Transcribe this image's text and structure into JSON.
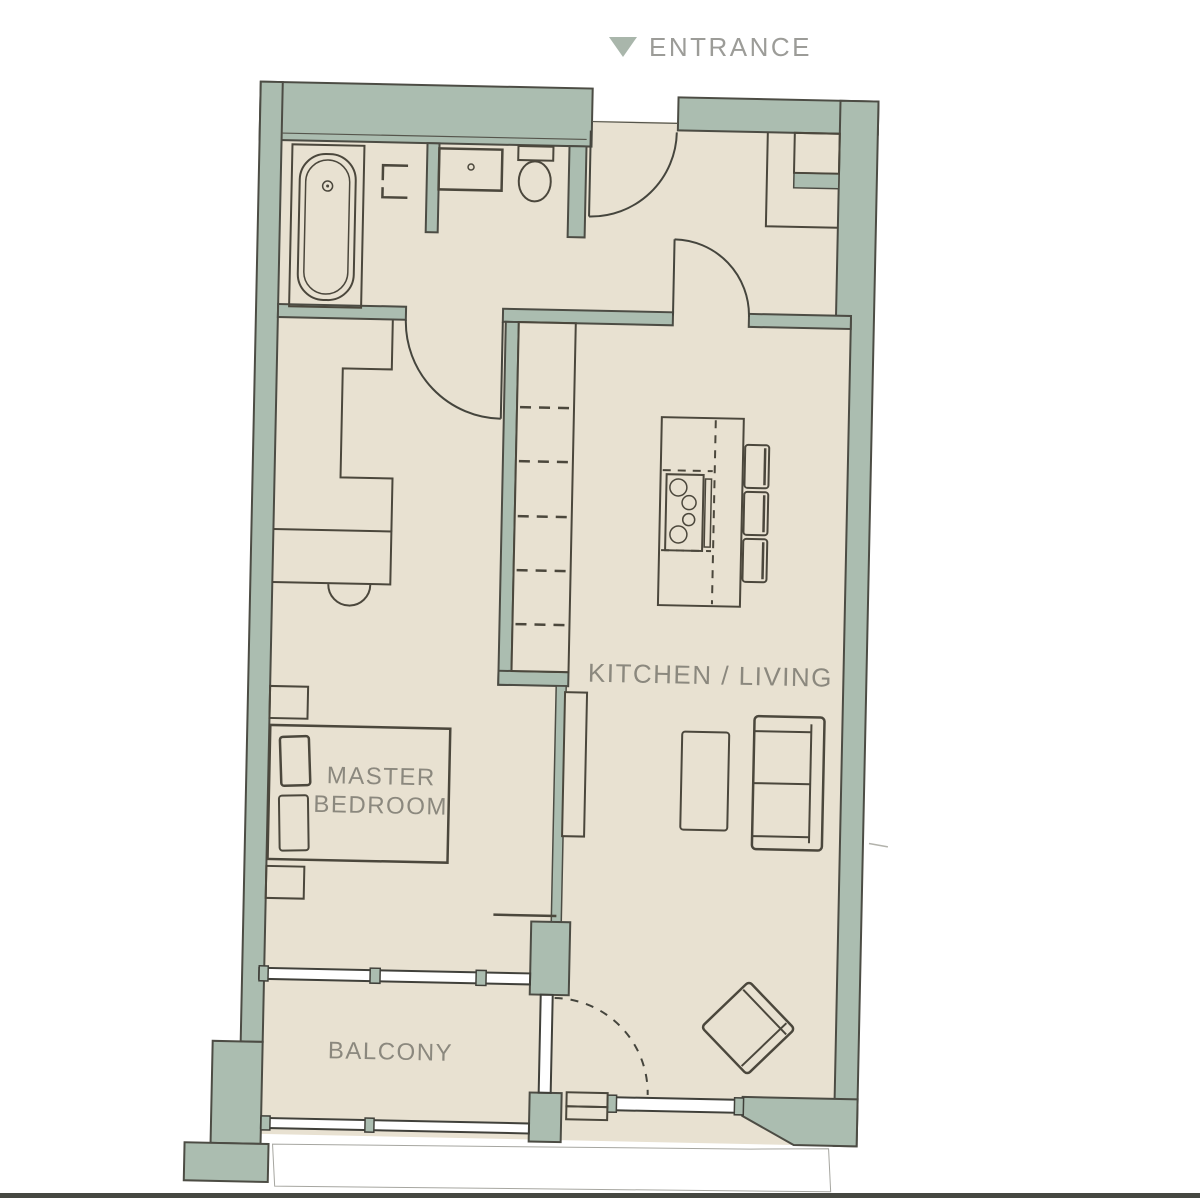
{
  "title": "apartment-floor-plan",
  "labels": {
    "entrance": "ENTRANCE",
    "kitchen_living": "KITCHEN / LIVING",
    "master_bedroom_line1": "MASTER",
    "master_bedroom_line2": "BEDROOM",
    "balcony": "BALCONY"
  },
  "rooms": [
    "entrance-hall",
    "bathroom",
    "master-bedroom",
    "kitchen-living",
    "balcony"
  ],
  "fixtures": [
    "bathtub",
    "wash-basin",
    "toilet",
    "towel-bracket",
    "wardrobe",
    "desk",
    "desk-chair",
    "double-bed",
    "pillows",
    "nightstands",
    "kitchen-counter",
    "kitchen-island",
    "hob",
    "utensil-rail",
    "bar-stools",
    "tv-unit",
    "coffee-table",
    "sofa",
    "armchair",
    "entrance-door",
    "bedroom-door",
    "living-room-door",
    "balcony-door",
    "balcony-window",
    "sliding-window",
    "balcony-railing",
    "storage-closet"
  ],
  "colors": {
    "wall": "#abbdb0",
    "floor": "#e8e1d1",
    "outline": "#4c4c44",
    "furniture_line": "#4b473c",
    "label_text": "#8b887e",
    "entrance_text": "#9c9c98",
    "entrance_arrow": "#a9b6ab",
    "background": "#ffffff",
    "bottom_border": "#464841"
  }
}
